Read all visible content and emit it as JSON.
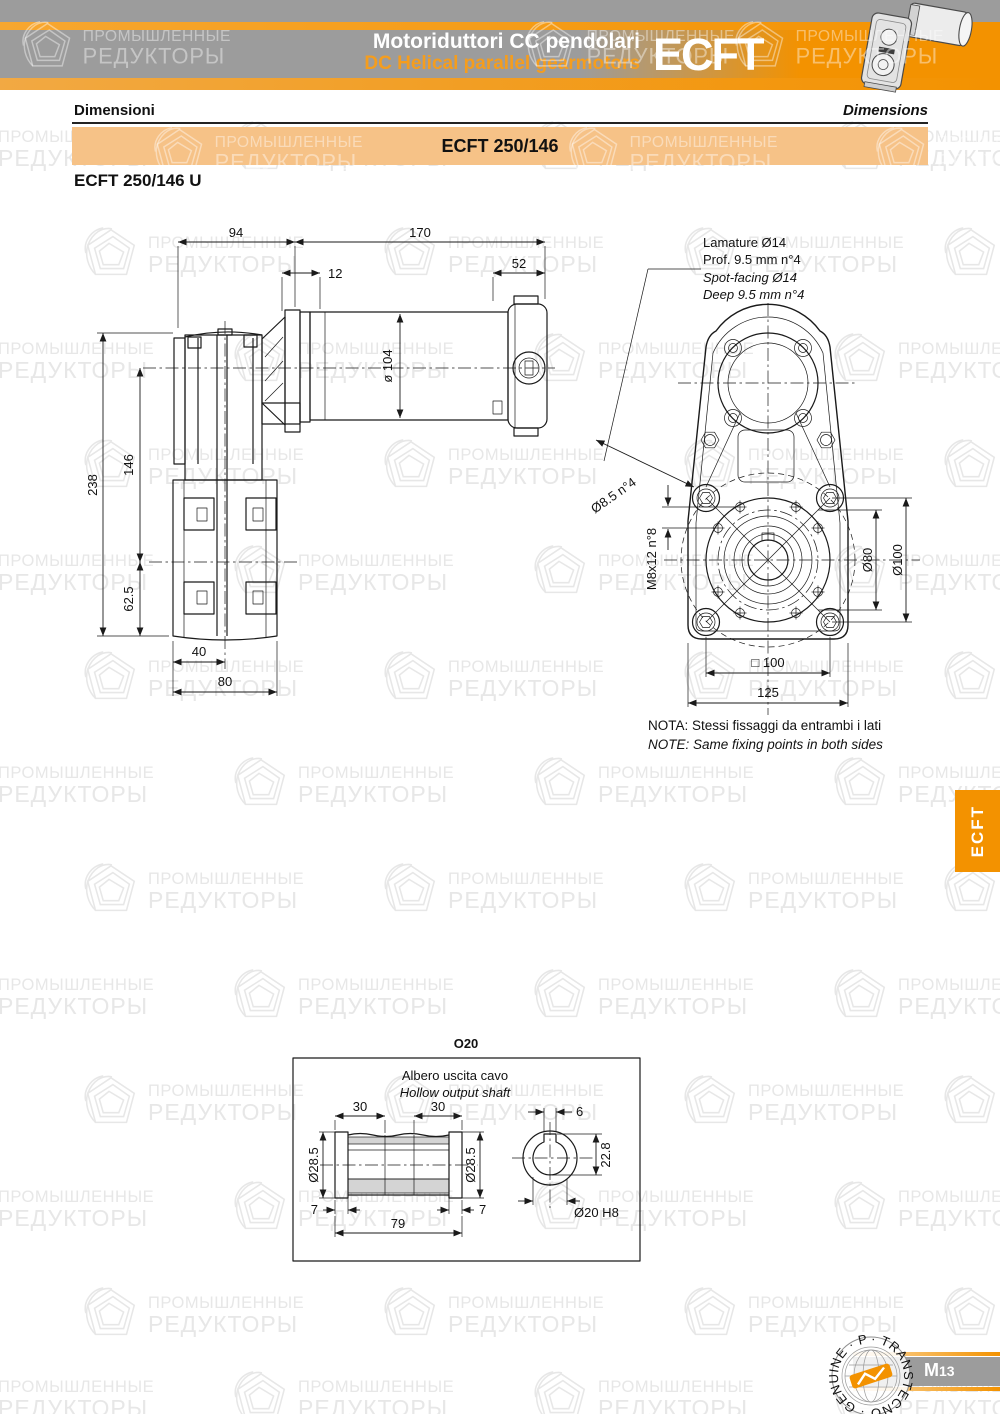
{
  "watermark": {
    "line1": "ПРОМЫШЛЕННЫЕ",
    "line2": "РЕДУКТОРЫ"
  },
  "header": {
    "title_it": "Motoriduttori CC pendolari",
    "title_en": "DC Helical parallel gearmotors",
    "brand": "ECFT"
  },
  "section": {
    "it": "Dimensioni",
    "en": "Dimensions"
  },
  "banner": {
    "model": "ECFT 250/146"
  },
  "variant_title": "ECFT 250/146 U",
  "side_view": {
    "dims": {
      "gearbox_width": "94",
      "motor_length": "170",
      "flange_offset": "12",
      "cap_length": "52",
      "motor_diameter": "ø 104",
      "overall_height": "238",
      "axis_distance": "146",
      "lower_height": "62.5",
      "shaft_offset": "40",
      "housing_width": "80"
    }
  },
  "front_view": {
    "spot_facing_note": {
      "it1": "Lamature Ø14",
      "it2": "Prof. 9.5 mm n°4",
      "en1": "Spot-facing Ø14",
      "en2": "Deep 9.5 mm n°4"
    },
    "dims": {
      "through_holes": "Ø8.5 n°4",
      "tapped_holes": "M8x12 n°8",
      "bolt_circle": "Ø80",
      "hub_diameter": "Ø100",
      "square": "□ 100",
      "overall_width": "125"
    }
  },
  "note": {
    "it": "NOTA:  Stessi fissaggi da entrambi i lati",
    "en": "NOTE: Same fixing points in both sides"
  },
  "side_tab": "ECFT",
  "option": {
    "code": "O20",
    "caption_it": "Albero uscita cavo",
    "caption_en": "Hollow output shaft",
    "dims": {
      "left_depth": "30",
      "right_depth": "30",
      "key_width": "6",
      "bore_left": "Ø28.5",
      "bore_right": "Ø28.5",
      "key_height": "22.8",
      "left_gap": "7",
      "right_gap": "7",
      "total_length": "79",
      "bore_fit": "Ø20 H8"
    }
  },
  "footer": {
    "page_letter": "M",
    "page_number": "13",
    "stamp_text": "· TRANSTECNO · GENUINE · PRODUCTS"
  },
  "colors": {
    "orange": "#F39200",
    "banner_fill": "#F6C287",
    "band_gray": "#9C9C9C"
  }
}
